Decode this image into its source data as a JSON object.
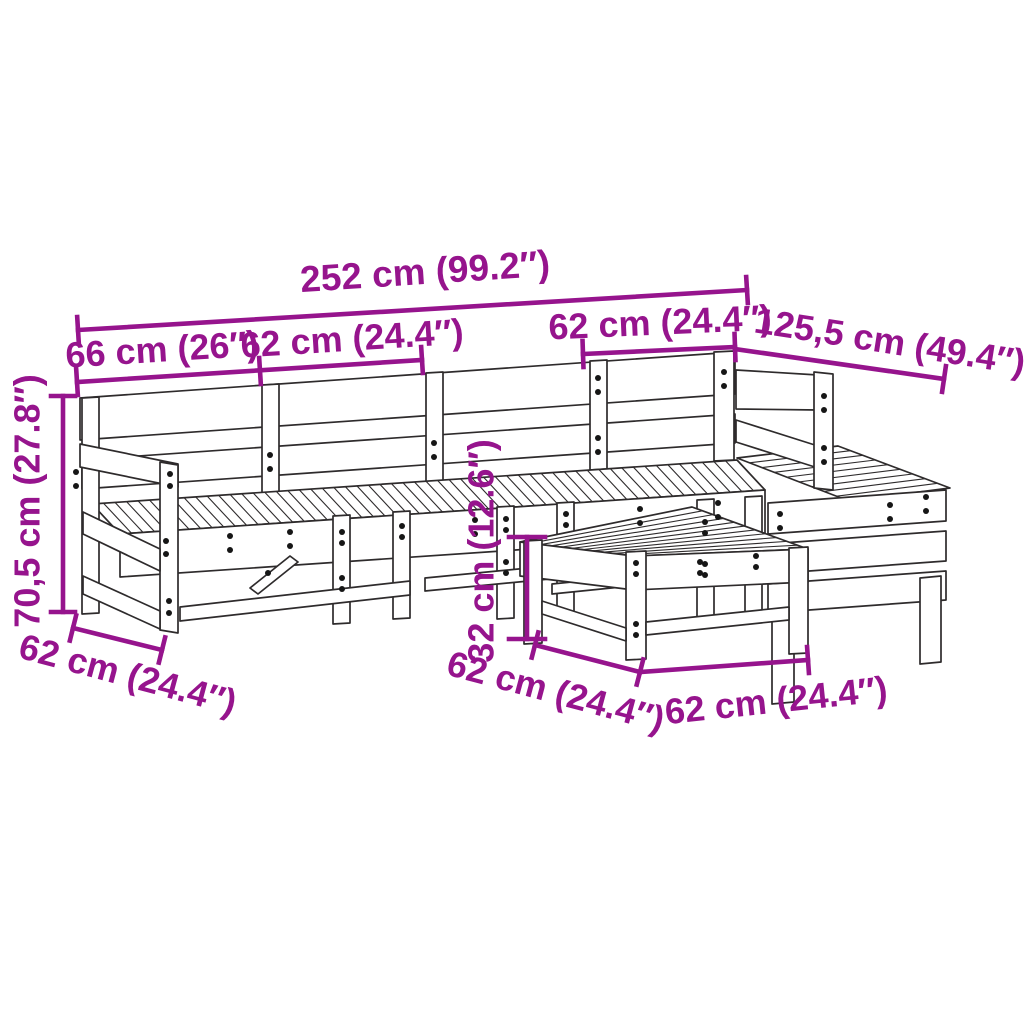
{
  "diagram": {
    "kind": "furniture dimension line drawing",
    "colors": {
      "dimension_annotation": "#96148d",
      "drawing_outline": "#2e2b2c",
      "background": "#ffffff"
    },
    "dimensions": {
      "total_width": "252 cm (99.2″)",
      "arm_module_width": "66 cm (26″)",
      "seat_module_width": "62 cm (24.4″)",
      "corner_module_width": "62 cm (24.4″)",
      "right_run_length": "125,5 cm (49.4″)",
      "back_height": "70,5 cm (27.8″)",
      "left_side_depth": "62 cm (24.4″)",
      "footstool_height": "32 cm (12.6″)",
      "footstool_depth": "62 cm (24.4″)",
      "footstool_width": "62 cm (24.4″)"
    }
  }
}
